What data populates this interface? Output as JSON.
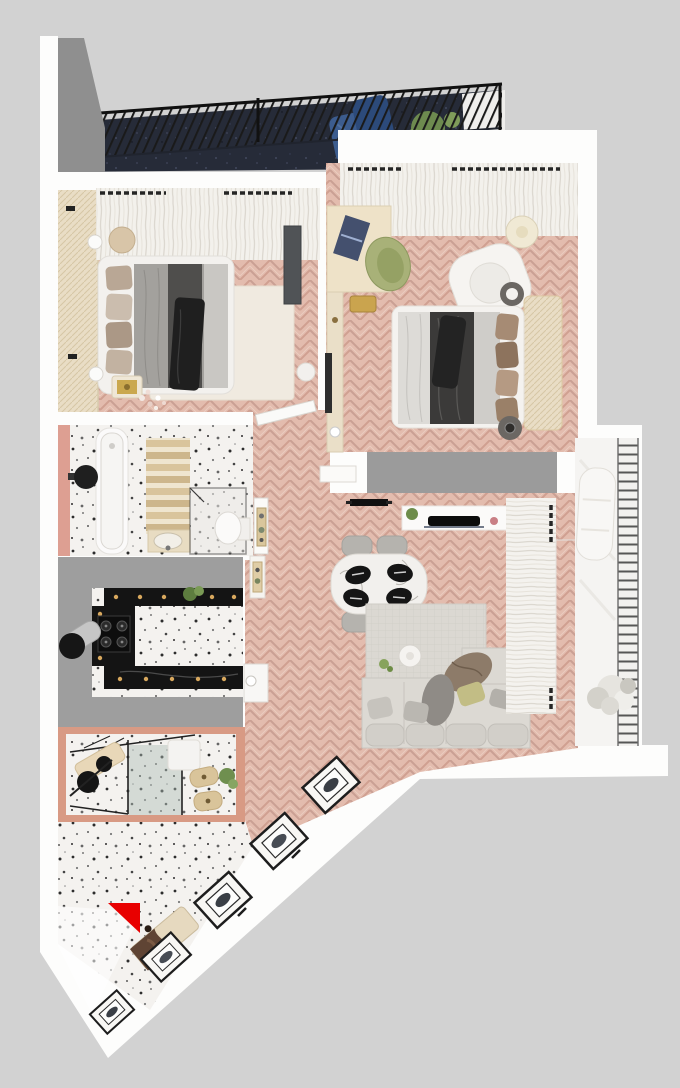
{
  "scene": {
    "title": "3D apartment floor plan, top-down render",
    "background_color": "#d2d2d2",
    "canvas": {
      "width": 680,
      "height": 1088
    }
  },
  "palette": {
    "wall_white": "#fdfdfc",
    "floor_pink_herringbone": "#e3bcae",
    "floor_terrazzo": "#f4f2ef",
    "balcony_dark_floor": "#262b38",
    "wall_grey_mass": "#9e9e9e",
    "counter_black_marble": "#141414",
    "accent_red": "#e80000",
    "wood_beige": "#e8dcc4",
    "chair_olive": "#a8b178",
    "sofa_grey": "#dcd9d3"
  },
  "rooms": [
    {
      "id": "balcony-top",
      "label": "Top balcony",
      "floor": "dark navy tile",
      "items": [
        "black metal railing",
        "blue lounge cushions",
        "potted plant",
        "grey corner wall"
      ]
    },
    {
      "id": "bedroom-1",
      "label": "Bedroom 1",
      "floor": "pink herringbone parquet",
      "items": [
        "double bed with grey bedding",
        "beige wardrobe strip",
        "sheer curtains",
        "dark wall console",
        "cream rug",
        "bedside lamps",
        "pouf",
        "gold tray table",
        "blossom branch"
      ]
    },
    {
      "id": "bedroom-2",
      "label": "Bedroom 2",
      "floor": "pink herringbone parquet",
      "items": [
        "desk with laptop",
        "olive desk chair",
        "white armchair",
        "floor lamp",
        "double bed with dark bedding",
        "upholstered headboard panel",
        "two round stools",
        "grey wardrobe",
        "wall TV strip",
        "sheer curtains"
      ]
    },
    {
      "id": "bathroom",
      "label": "Bathroom",
      "floor": "white terrazzo",
      "items": [
        "bathtub",
        "black vessel sink",
        "wooden towel ladder",
        "vanity with sink",
        "glass shower",
        "toilet",
        "salmon accent wall"
      ]
    },
    {
      "id": "kitchen",
      "label": "Kitchen",
      "floor": "white terrazzo",
      "items": [
        "black marble counters with warm spotlights",
        "gas hob",
        "chrome extractor hood",
        "plant"
      ]
    },
    {
      "id": "study",
      "label": "Glass study",
      "floor": "terrazzo with terracotta border",
      "items": [
        "glass partition",
        "desk",
        "black chair discs",
        "wooden stools",
        "plant"
      ]
    },
    {
      "id": "hallway",
      "label": "Hallway",
      "floor": "pink herringbone parquet",
      "items": [
        "wall-mounted TV",
        "door leaves with brass handle plates"
      ]
    },
    {
      "id": "living-room",
      "label": "Living room",
      "floor": "pink herringbone parquet",
      "items": [
        "white TV console",
        "dining table with four black place settings",
        "four grey chairs",
        "area rug",
        "L-shaped grey sofa with pillows",
        "olive pillow",
        "coffee table",
        "sheer curtains"
      ]
    },
    {
      "id": "balcony-right",
      "label": "Right balcony",
      "floor": "light concrete",
      "items": [
        "horizontal slat railing",
        "white lounge chair",
        "fluffy white plant"
      ]
    },
    {
      "id": "entry",
      "label": "Entry hall",
      "floor": "terrazzo",
      "items": [
        "red triangle marker",
        "marble bench",
        "five leaning picture frames",
        "diagonal wall"
      ]
    }
  ],
  "marker": {
    "id": "red-triangle",
    "color": "#e80000",
    "shape": "triangle",
    "location": "entry hall"
  }
}
